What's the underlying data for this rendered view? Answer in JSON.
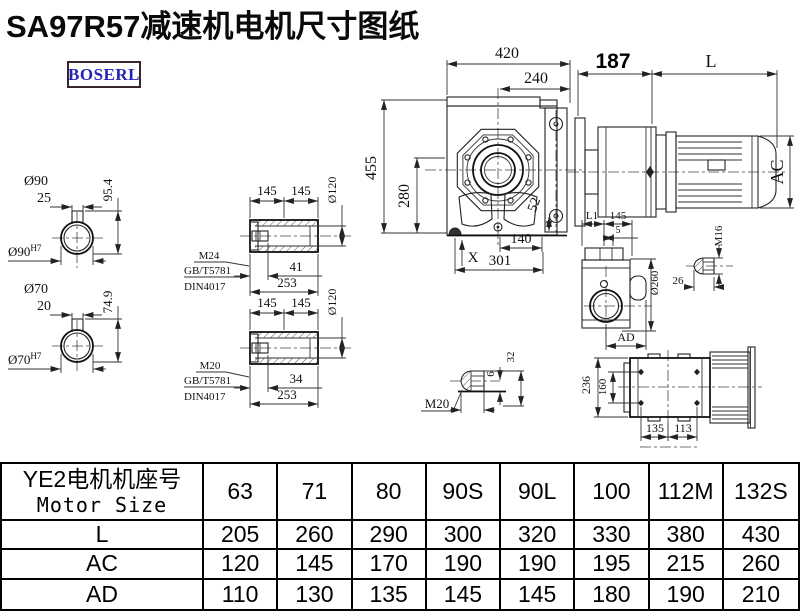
{
  "title": "SA97R57减速机电机尺寸图纸",
  "logo": "BOSERL",
  "main": {
    "w": "420",
    "w2": "240",
    "h": "455",
    "h2": "280",
    "k": "52",
    "x": "X",
    "b1": "140",
    "b2": "301"
  },
  "motor": {
    "a": "187",
    "l": "L",
    "ac": "AC"
  },
  "s90": {
    "d": "Ø90",
    "l": "25",
    "h": "95.4",
    "bore": "Ø90",
    "tol": "H7"
  },
  "s70": {
    "d": "Ø70",
    "l": "20",
    "h": "74.9",
    "bore": "Ø70",
    "tol": "H7"
  },
  "h1": {
    "a": "145",
    "b": "145",
    "d": "Ø120",
    "m": "M24",
    "g": "GB/T5781",
    "n": "DIN4017",
    "t": "41",
    "len": "253"
  },
  "h2": {
    "a": "145",
    "b": "145",
    "d": "Ø120",
    "m": "M20",
    "g": "GB/T5781",
    "n": "DIN4017",
    "t": "34",
    "len": "253"
  },
  "sv": {
    "l1": "L1",
    "a": "145",
    "b": "5",
    "d": "Ø260",
    "ad": "AD"
  },
  "p16": {
    "m": "M16",
    "l": "26"
  },
  "p20": {
    "m": "M20",
    "a": "6",
    "b": "32"
  },
  "bv": {
    "h": "236",
    "h2": "160",
    "w": "135",
    "w2": "113"
  },
  "table": {
    "head_cn": "YE2电机机座号",
    "head_en": "Motor Size",
    "cols": [
      "63",
      "71",
      "80",
      "90S",
      "90L",
      "100",
      "112M",
      "132S"
    ],
    "rows": [
      {
        "label": "L",
        "v": [
          "205",
          "260",
          "290",
          "300",
          "320",
          "330",
          "380",
          "430"
        ]
      },
      {
        "label": "AC",
        "v": [
          "120",
          "145",
          "170",
          "190",
          "190",
          "195",
          "215",
          "260"
        ]
      },
      {
        "label": "AD",
        "v": [
          "110",
          "130",
          "135",
          "145",
          "145",
          "180",
          "190",
          "210"
        ]
      }
    ]
  }
}
